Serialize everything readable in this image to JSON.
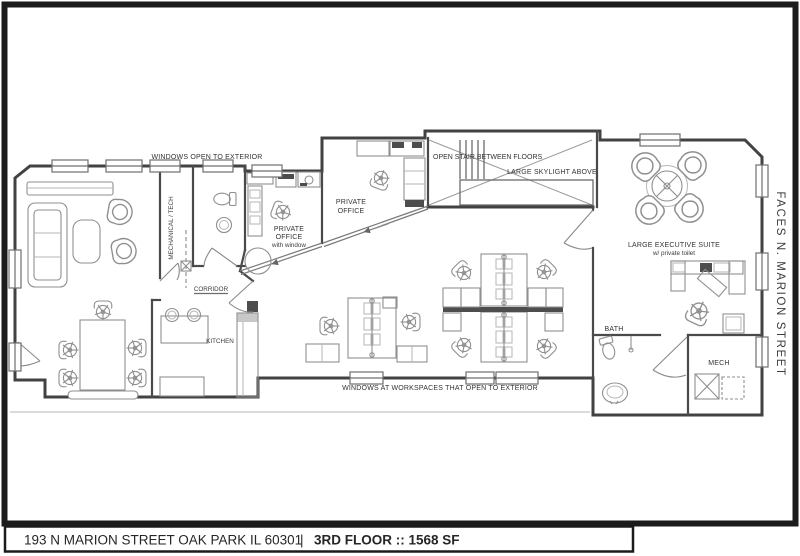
{
  "title_bar": {
    "address": "193 N MARION STREET  OAK PARK IL 60301",
    "separator": "|",
    "floor_info": "3RD FLOOR :: 1568 SF"
  },
  "annotations": {
    "faces_street": "FACES N. MARION STREET",
    "windows_open_exterior": "WINDOWS OPEN TO EXTERIOR",
    "windows_workspaces": "WINDOWS AT WORKSPACES THAT OPEN TO EXTERIOR",
    "open_stair": "OPEN STAIR BETWEEN FLOORS",
    "skylight": "LARGE SKYLIGHT ABOVE"
  },
  "rooms": {
    "mechanical_tech": "MECHANICAL / TECH",
    "corridor": "CORRIDOR",
    "kitchen": "KITCHEN",
    "bath": "BATH",
    "mech": "MECH",
    "private_office_1": {
      "line1": "PRIVATE",
      "line2": "OFFICE",
      "line3": "with window"
    },
    "private_office_2": {
      "line1": "PRIVATE",
      "line2": "OFFICE"
    },
    "executive_suite": {
      "line1": "LARGE EXECUTIVE SUITE",
      "line2": "w/ private toilet"
    }
  },
  "colors": {
    "frame": "#1b1b1b",
    "wall": "#4a4a4a",
    "furniture_line": "#8f8f8f",
    "light_line": "#b5b5b5",
    "label_text": "#333333",
    "background": "#ffffff"
  }
}
